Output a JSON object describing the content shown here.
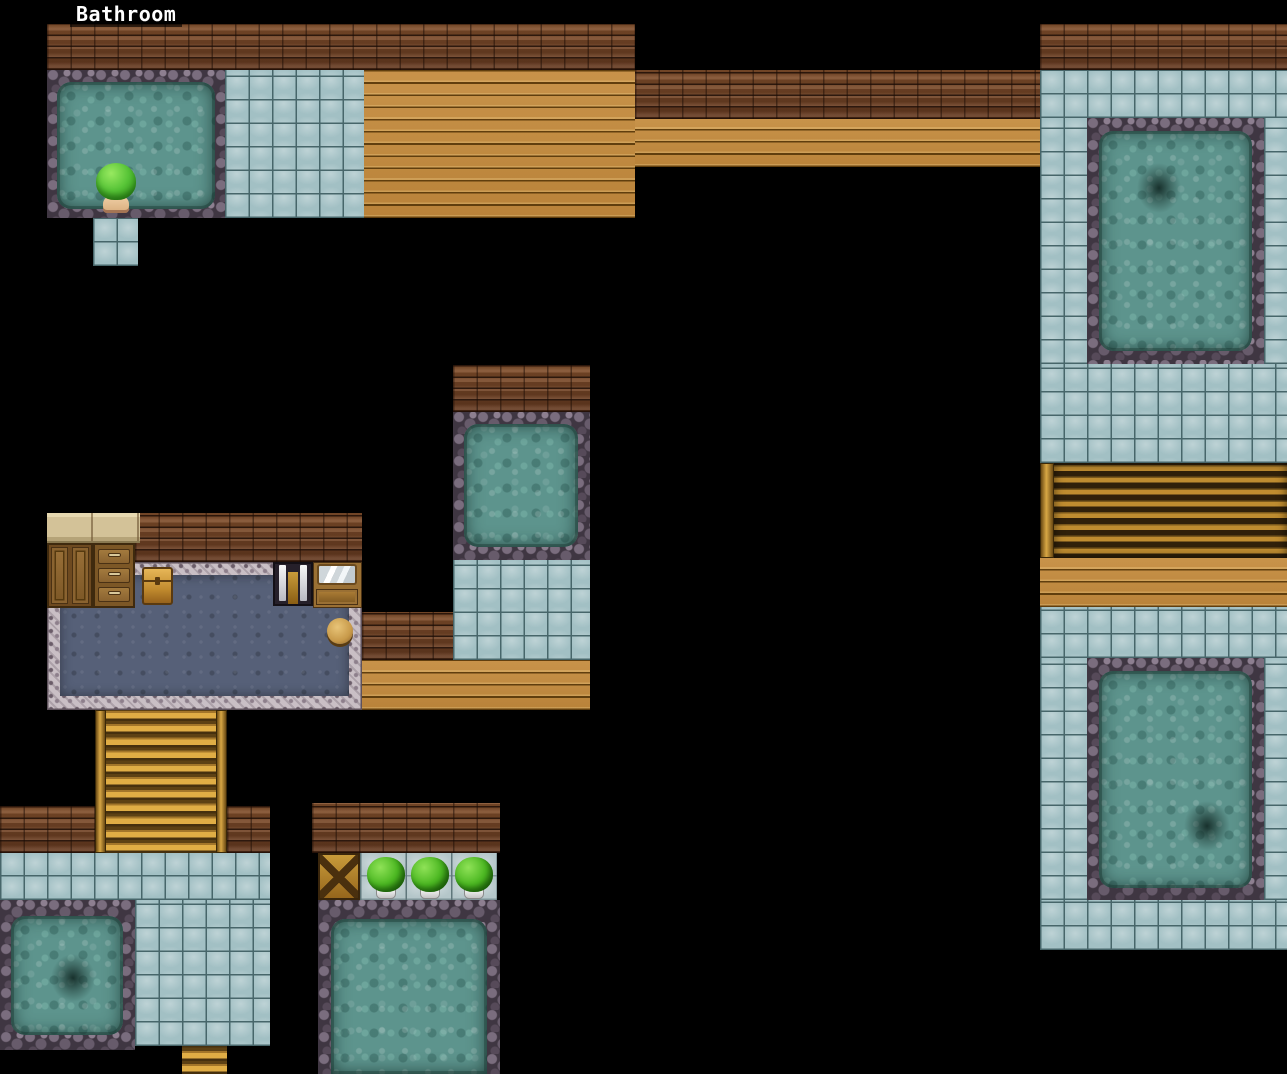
{
  "hud": {
    "location_label": "Bathroom"
  },
  "player": {
    "description": "green-haired character seen from behind, bathing at the edge of the upper-left pool",
    "hair_color": "#57c437",
    "skin_color": "#ecc9a0"
  },
  "map": {
    "name": "Bathroom",
    "features": [
      "six stone-bordered bathing pools with teal water",
      "light blue tiled floors",
      "golden wooden plank walkways",
      "brown brick walls",
      "two ladder-style staircases and one dark descending stair band",
      "dressing room with counter, wardrobe, three-drawer dresser, wooden chest, towel locker, mirrored vanity, round stool and ornate blue carpet",
      "three potted green bushes on a light tile ledge",
      "crossed wood pile",
      "dark drain shadows in three pools"
    ]
  },
  "palette": {
    "background": "#000000",
    "brick": "#74432a",
    "wood_floor": "#c08a40",
    "tile_floor": "#a2c0c4",
    "tile_grout": "#47666a",
    "stone_border": "#3f3642",
    "water": "#5d948d",
    "stair_gold": "#e0ad45",
    "carpet_inner": "#566078",
    "carpet_border": "#c9bfc5",
    "bush_green": "#4cb822"
  }
}
